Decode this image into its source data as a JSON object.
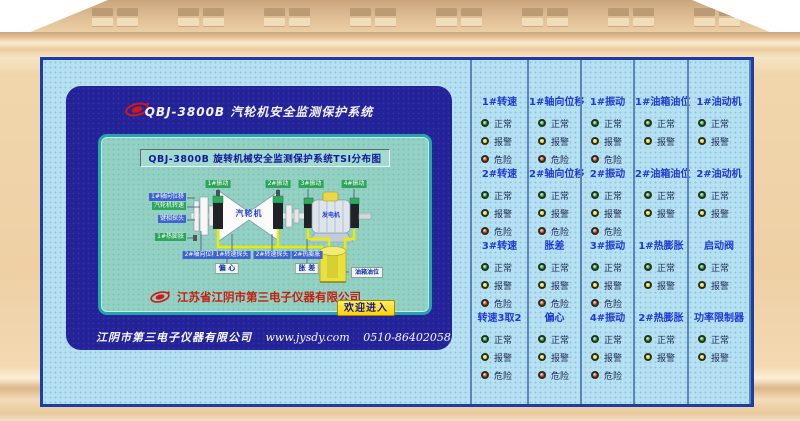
{
  "screen": {
    "header_title": "QBJ-3800B  汽轮机安全监测保护系统",
    "display_title": "QBJ-3800B 旋转机械安全监测保护系统TSI分布图",
    "company_name": "江苏省江阴市第三电子仪器有限公司",
    "enter_button": "欢迎进入",
    "footer": {
      "company": "江阴市第三电子仪器有限公司",
      "website": "www.jysdy.com",
      "phone": "0510-86402058"
    },
    "diagram": {
      "turbine_label": "汽轮机",
      "generator_label": "发电机",
      "top_sensors": [
        "1#振动",
        "2#振动",
        "3#振动",
        "4#振动"
      ],
      "left_sensors": [
        {
          "label": "1#轴向位移",
          "type": "blue"
        },
        {
          "label": "汽轮机转速",
          "type": "green"
        },
        {
          "label": "键相探头",
          "type": "blue"
        },
        {
          "label": "1#热膨胀",
          "type": "green"
        }
      ],
      "bottom_sensors": [
        "2#轴向位移",
        "1#转速探头",
        "2#转速探头",
        "2#热膨胀"
      ],
      "measure_boxes": [
        "偏 心",
        "胀 差"
      ],
      "tank_label": "油箱油位"
    }
  },
  "status_panel": {
    "state_colors": {
      "正常": "#17b117",
      "报警": "#ffd400",
      "危险": "#ff2600"
    },
    "columns": [
      {
        "cells": [
          {
            "label": "1#转速",
            "states": [
              "正常",
              "报警",
              "危险"
            ]
          },
          {
            "label": "2#转速",
            "states": [
              "正常",
              "报警",
              "危险"
            ]
          },
          {
            "label": "3#转速",
            "states": [
              "正常",
              "报警",
              "危险"
            ]
          },
          {
            "label": "转速3取2",
            "states": [
              "正常",
              "报警",
              "危险"
            ]
          }
        ]
      },
      {
        "cells": [
          {
            "label": "1#轴向位移",
            "states": [
              "正常",
              "报警",
              "危险"
            ]
          },
          {
            "label": "2#轴向位移",
            "states": [
              "正常",
              "报警",
              "危险"
            ]
          },
          {
            "label": "胀差",
            "states": [
              "正常",
              "报警",
              "危险"
            ]
          },
          {
            "label": "偏心",
            "states": [
              "正常",
              "报警",
              "危险"
            ]
          }
        ]
      },
      {
        "cells": [
          {
            "label": "1#振动",
            "states": [
              "正常",
              "报警",
              "危险"
            ]
          },
          {
            "label": "2#振动",
            "states": [
              "正常",
              "报警",
              "危险"
            ]
          },
          {
            "label": "3#振动",
            "states": [
              "正常",
              "报警",
              "危险"
            ]
          },
          {
            "label": "4#振动",
            "states": [
              "正常",
              "报警",
              "危险"
            ]
          }
        ]
      },
      {
        "cells": [
          {
            "label": "1#油箱油位",
            "states": [
              "正常",
              "报警"
            ]
          },
          {
            "label": "2#油箱油位",
            "states": [
              "正常",
              "报警"
            ]
          },
          {
            "label": "1#热膨胀",
            "states": [
              "正常",
              "报警"
            ]
          },
          {
            "label": "2#热膨胀",
            "states": [
              "正常",
              "报警"
            ]
          }
        ]
      },
      {
        "cells": [
          {
            "label": "1#油动机",
            "states": [
              "正常",
              "报警"
            ]
          },
          {
            "label": "2#油动机",
            "states": [
              "正常",
              "报警"
            ]
          },
          {
            "label": "启动阀",
            "states": [
              "正常",
              "报警"
            ]
          },
          {
            "label": "功率限制器",
            "states": [
              "正常",
              "报警"
            ]
          }
        ]
      }
    ]
  },
  "colors": {
    "casing": "#eed0a4",
    "panel_bg": "#b6e1f2",
    "panel_border": "#1d3da6",
    "screen_bg": "#232299",
    "display_bg": "#92d1c3",
    "sensor_green": "#2ea45c",
    "sensor_blue": "#3f63cf",
    "company_red": "#c41f10",
    "button_yellow": "#ffd402"
  }
}
